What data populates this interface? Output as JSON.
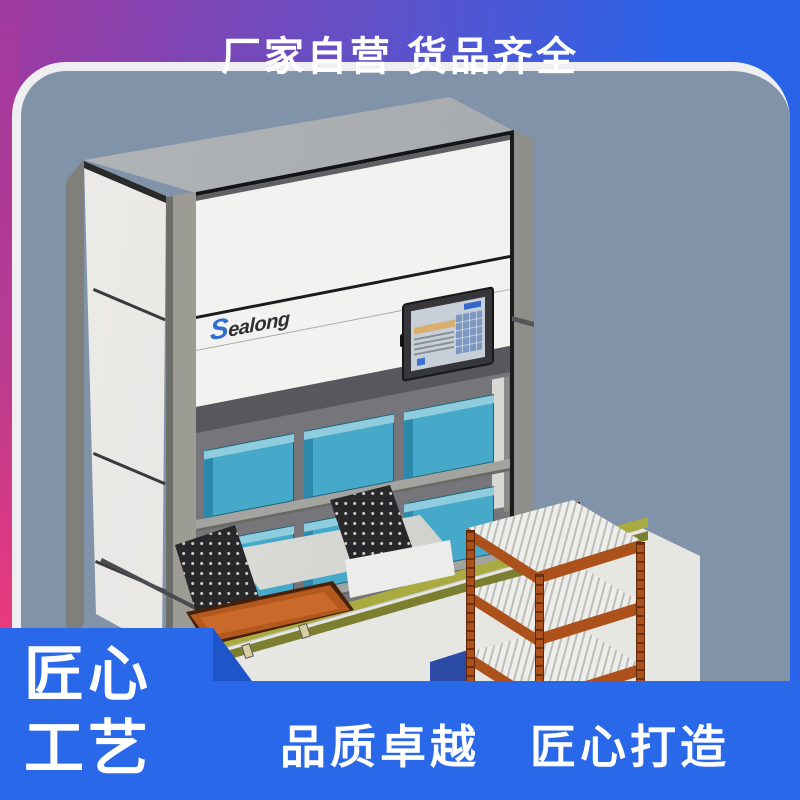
{
  "top_banner": {
    "text": "厂家自营 货品齐全"
  },
  "machine": {
    "brand": "Sealong",
    "description": "vertical lift storage cabinet with touch screen, 6 teal storage bins on 2 shelves, extractor drawer with orange tray, conveyor strip and orange roller cart"
  },
  "badge": {
    "line1": "匠心",
    "line2": "工艺"
  },
  "bottom_banner": {
    "text": "品质卓越　匠心打造"
  },
  "colors": {
    "frame_purple": "#A03AA0",
    "frame_blue": "#2B63E8",
    "frame_pink": "#EE3A7B",
    "panel_slate": "#8093A9",
    "panel_border": "#EFEFF2",
    "banner_blue": "#2968E8",
    "wedge_blue": "#1E55C8",
    "machine_white": "#F2F2F0",
    "compartment_gray": "#75757A",
    "bin_teal": "#46A9CA",
    "bin_teal_dark": "#2C89AC",
    "bin_teal_light": "#8FCCDE",
    "cart_orange": "#AC511B",
    "slat_white": "#EDEDEA",
    "tray_orange": "#B4591D",
    "conveyor_olive": "#A9AB41",
    "conveyor_olive_dark": "#7D7F30",
    "base_gray": "#E6E6E3",
    "logo_blue": "#2E6FD0",
    "logo_dark": "#2F2F33",
    "screen_bezel": "#37373B",
    "screen_bg": "#C7CFD9"
  }
}
